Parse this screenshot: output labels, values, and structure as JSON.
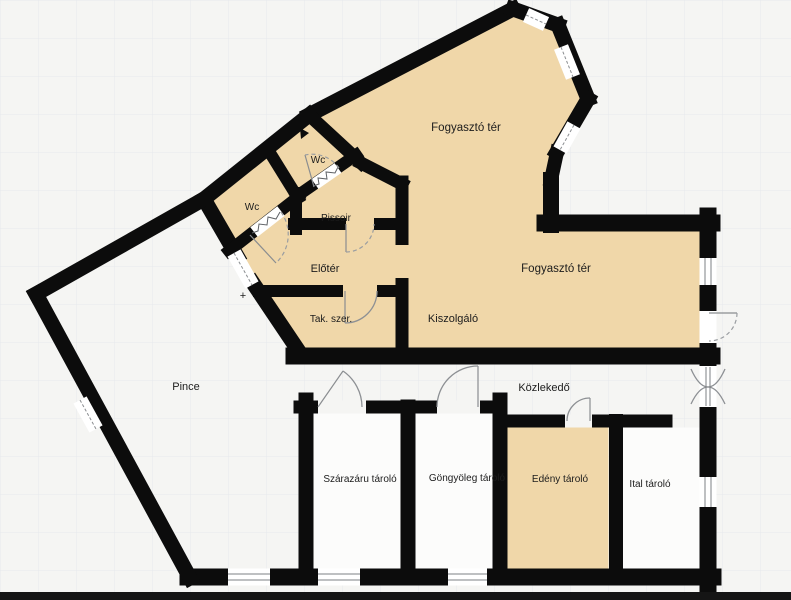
{
  "plan": {
    "type": "floor-plan",
    "language": "hu",
    "colors": {
      "room_fill": "#f0d7a9",
      "wall": "#0c0c0c",
      "background": "#f5f5f3",
      "grid": "#e7e9ec",
      "white_room": "#fcfcfb",
      "door_arc": "#8d9094",
      "bottom_bar": "#151515"
    },
    "rooms": [
      {
        "id": "fogyaszto-ter-upper",
        "label": "Fogyasztó tér"
      },
      {
        "id": "wc-upper",
        "label": "Wc"
      },
      {
        "id": "wc-left",
        "label": "Wc"
      },
      {
        "id": "pissoir",
        "label": "Pissoir"
      },
      {
        "id": "eloter",
        "label": "Előtér"
      },
      {
        "id": "tak-szer",
        "label": "Tak. szer."
      },
      {
        "id": "kiszolgalo",
        "label": "Kiszolgáló"
      },
      {
        "id": "fogyaszto-ter-lower",
        "label": "Fogyasztó tér"
      },
      {
        "id": "pince",
        "label": "Pince"
      },
      {
        "id": "kozlekedo",
        "label": "Közlekedő"
      },
      {
        "id": "szarazaru-tarolo",
        "label": "Szárazáru tároló"
      },
      {
        "id": "gongyoleg-tarolo",
        "label": "Göngyöleg tároló"
      },
      {
        "id": "edeny-tarolo",
        "label": "Edény tároló"
      },
      {
        "id": "ital-tarolo",
        "label": "Ital tároló"
      }
    ],
    "markers": {
      "entrance_plus": "+"
    }
  }
}
